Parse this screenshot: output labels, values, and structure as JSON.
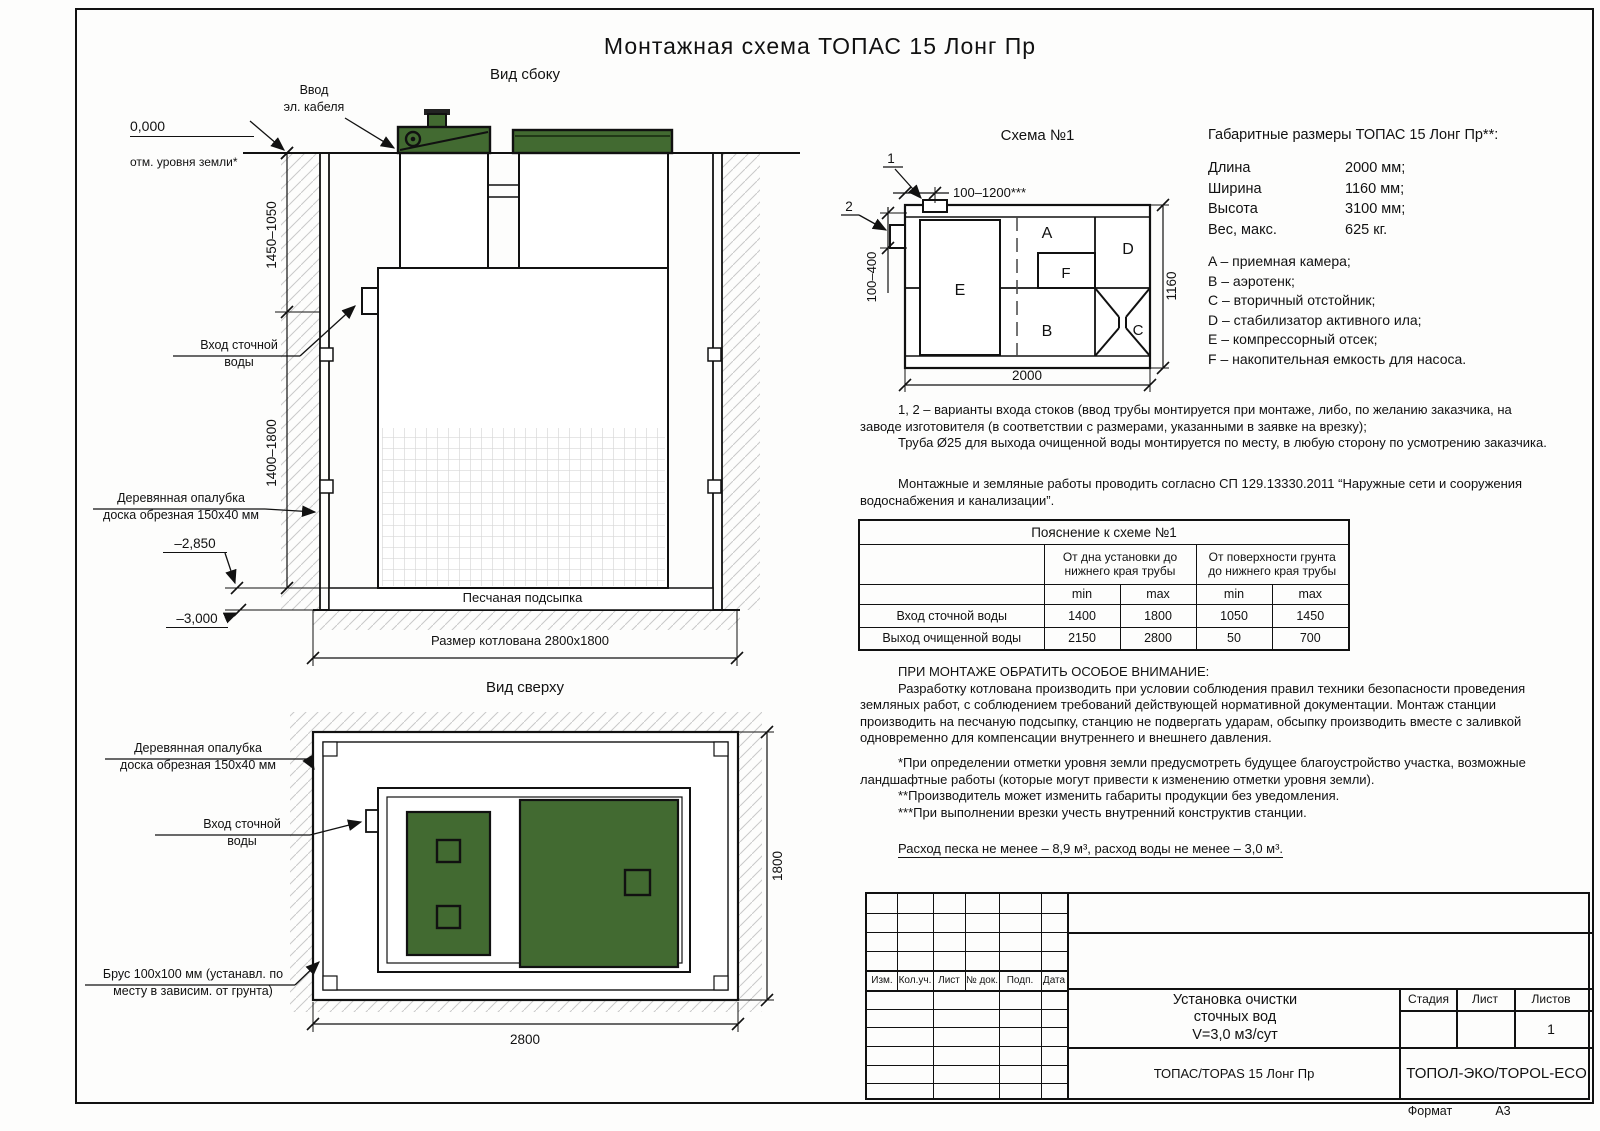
{
  "page": {
    "title": "Монтажная схема ТОПАС 15 Лонг Пр",
    "format_label": "Формат",
    "format_value": "А3"
  },
  "side_view": {
    "title": "Вид сбоку",
    "zero_mark": "0,000",
    "zero_label": "отм. уровня земли*",
    "cable_entry": "Ввод\nэл. кабеля",
    "inlet": "Вход сточной\nводы",
    "formwork": "Деревянная опалубка\nдоска обрезная 150х40 мм",
    "dim_upper": "1450–1050",
    "dim_lower": "1400–1800",
    "mark_sand_top": "–2,850",
    "mark_bottom": "–3,000",
    "sand_label": "Песчаная подсыпка",
    "pit_size": "Размер котлована 2800х1800"
  },
  "schema": {
    "title": "Схема №1",
    "callout_1": "1",
    "callout_2": "2",
    "dim_top": "100–1200***",
    "dim_left": "100–400",
    "dim_width": "2000",
    "dim_height": "1160",
    "comp_a": "A",
    "comp_b": "B",
    "comp_c": "C",
    "comp_d": "D",
    "comp_e": "E",
    "comp_f": "F"
  },
  "dimensions": {
    "title": "Габаритные размеры ТОПАС 15 Лонг Пр**:",
    "rows": [
      {
        "label": "Длина",
        "value": "2000 мм;"
      },
      {
        "label": "Ширина",
        "value": "1160 мм;"
      },
      {
        "label": "Высота",
        "value": "3100 мм;"
      },
      {
        "label": "Вес, макс.",
        "value": "625 кг."
      }
    ]
  },
  "legend": [
    "A – приемная камера;",
    "B – аэротенк;",
    "C – вторичный отстойник;",
    "D – стабилизатор активного ила;",
    "E – компрессорный отсек;",
    "F – накопительная емкость для насоса."
  ],
  "notes": {
    "variants": "1, 2 – варианты входа  стоков (ввод трубы монтируется при монтаже, либо, по желанию заказчика, на заводе изготовителя (в соответствии с размерами, указанными в заявке на врезку);",
    "pipe": "Труба Ø25 для выхода очищенной воды монтируется по месту, в любую сторону по усмотрению заказчика.",
    "sp": "Монтажные и земляные работы проводить согласно СП 129.13330.2011 “Наружные сети и сооружения водоснабжения и канализации”.",
    "attention_title": "ПРИ МОНТАЖЕ ОБРАТИТЬ ОСОБОЕ ВНИМАНИЕ:",
    "attention_body": "Разработку котлована производить при условии соблюдения правил техники безопасности проведения земляных работ, с соблюдением требований действующей нормативной документации. Монтаж станции производить на песчаную подсыпку, станцию не подвергать ударам, обсыпку производить вместе с заливкой одновременно для компенсации внутреннего и внешнего давления.",
    "star1": "*При определении отметки уровня земли предусмотреть будущее благоустройство участка, возможные ландшафтные работы (которые могут привести к изменению отметки уровня земли).",
    "star2": "**Производитель может изменить габариты продукции без уведомления.",
    "star3": "***При выполнении врезки учесть внутренний конструктив станции.",
    "consumption": "Расход песка не менее – 8,9 м³, расход воды не менее – 3,0 м³."
  },
  "table": {
    "title": "Пояснение к схеме №1",
    "col_group1": "От дна установки до\nнижнего края трубы",
    "col_group2": "От поверхности грунта\nдо нижнего края трубы",
    "min": "min",
    "max": "max",
    "rows": [
      {
        "label": "Вход сточной воды",
        "v": [
          "1400",
          "1800",
          "1050",
          "1450"
        ]
      },
      {
        "label": "Выход очищенной воды",
        "v": [
          "2150",
          "2800",
          "50",
          "700"
        ]
      }
    ]
  },
  "top_view": {
    "title": "Вид сверху",
    "formwork": "Деревянная опалубка\nдоска обрезная 150х40 мм",
    "inlet": "Вход сточной\nводы",
    "beam": "Брус 100х100 мм (устанавл. по\nместу в зависим. от грунта)",
    "dim_width": "2800",
    "dim_height": "1800"
  },
  "title_block": {
    "rev_headers": [
      "Изм.",
      "Кол.уч.",
      "Лист",
      "№ док.",
      "Подп.",
      "Дата"
    ],
    "doc_title": "Установка очистки\nсточных вод\nV=3,0 м3/сут",
    "stage_label": "Стадия",
    "sheet_label": "Лист",
    "sheets_label": "Листов",
    "sheets_value": "1",
    "product": "ТОПАС/TOPAS 15 Лонг Пр",
    "company": "ТОПОЛ-ЭКО/TOPOL-ECO"
  },
  "colors": {
    "lid_green": "#426a31",
    "line": "#111111",
    "hatch": "#c9c9c9"
  }
}
